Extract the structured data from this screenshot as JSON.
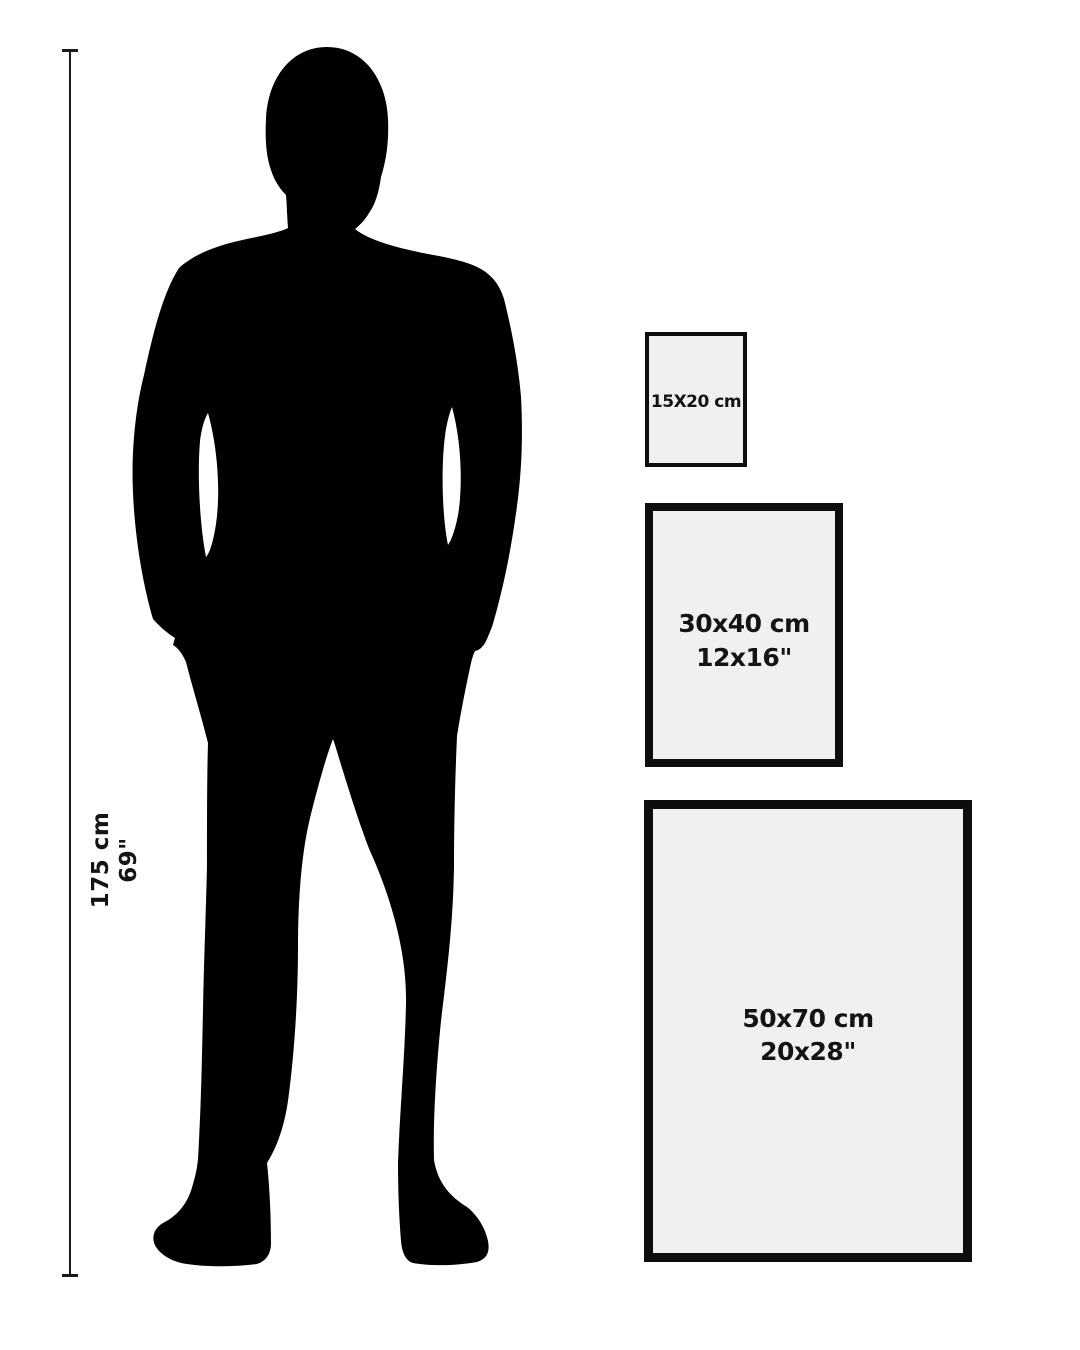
{
  "measure": {
    "height_cm": "175 cm",
    "height_in": "69\""
  },
  "figure": {
    "icon": "man-silhouette"
  },
  "frames": [
    {
      "size_cm": "15X20 cm"
    },
    {
      "size_cm": "30x40 cm",
      "size_in": "12x16\""
    },
    {
      "size_cm": "50x70 cm",
      "size_in": "20x28\""
    }
  ],
  "colors": {
    "background": "#ffffff",
    "silhouette": "#000000",
    "frame_fill": "#f0f0f0",
    "frame_border": "#0d0d0d",
    "text": "#141414",
    "measure_line": "#1a1a1a"
  }
}
